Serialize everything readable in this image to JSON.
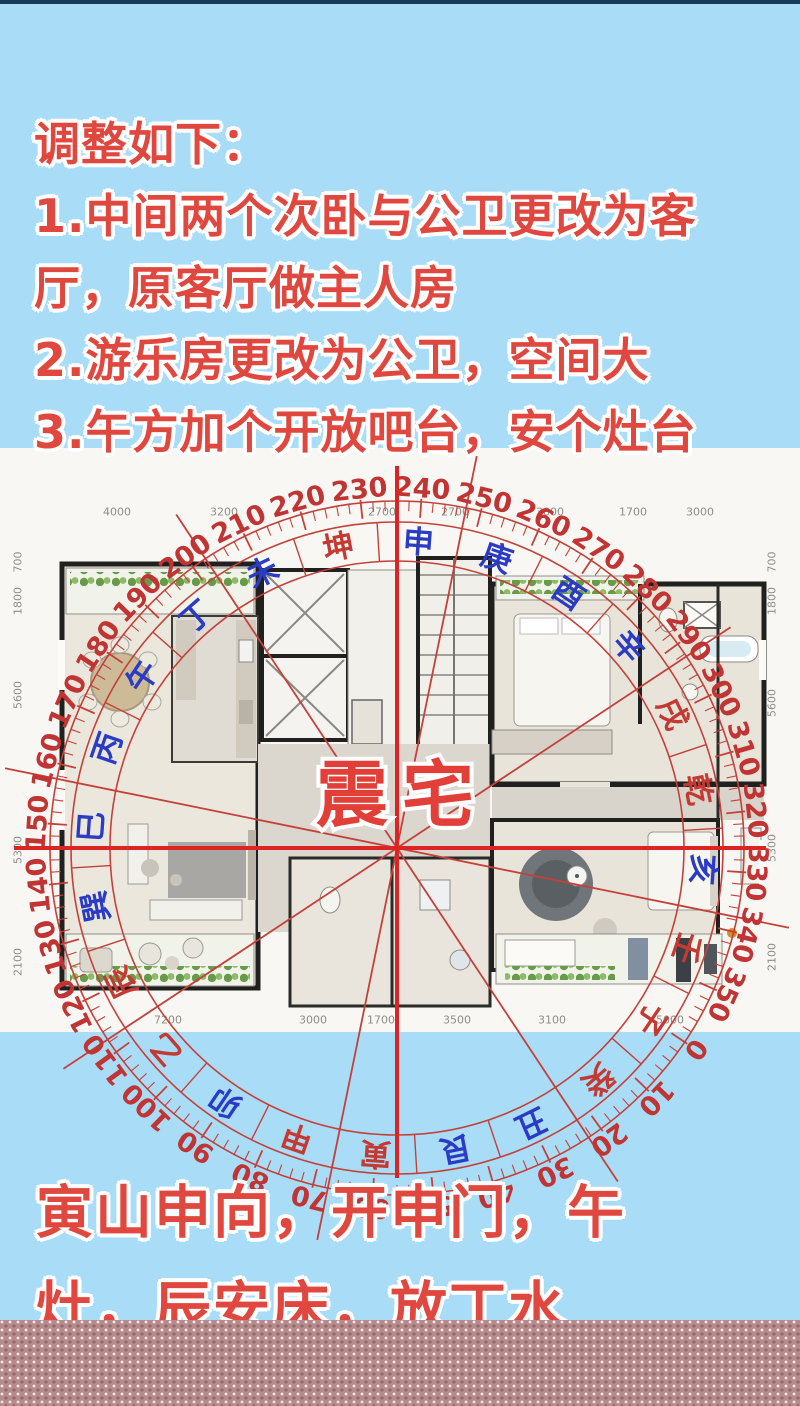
{
  "page": {
    "background_color": "#a9dcf7",
    "top_bar_color": "#16395e",
    "band_color": "#b78a8b"
  },
  "top_text": {
    "color": "#e0483f",
    "lines": [
      "调整如下：",
      "1.中间两个次卧与公卫更改为客",
      "厅，原客厅做主人房",
      "2.游乐房更改为公卫，空间大",
      "3.午方加个开放吧台，安个灶台"
    ]
  },
  "bottom_text": {
    "color": "#e0483f",
    "lines": [
      "寅山申向，开申门，午",
      "灶，辰安床，放丁水"
    ]
  },
  "compass": {
    "center_label": "震宅",
    "center_label_color": "#e23f38",
    "ring_color": "#c4413a",
    "crosshair_color": "#dd2424",
    "degree_label_color": "#c13434",
    "rotation_deg": 124,
    "degree_labels": [
      "0",
      "10",
      "20",
      "30",
      "40",
      "50",
      "60",
      "70",
      "80",
      "90",
      "100",
      "110",
      "120",
      "130",
      "140",
      "150",
      "160",
      "170",
      "180",
      "190",
      "200",
      "210",
      "220",
      "230",
      "240",
      "250",
      "260",
      "270",
      "280",
      "290",
      "300",
      "310",
      "320",
      "330",
      "340",
      "350"
    ],
    "mountain_colors": {
      "red": "#c43a33",
      "blue": "#2b3bc4"
    },
    "mountains": [
      {
        "name": "子",
        "deg": 0,
        "color": "red"
      },
      {
        "name": "癸",
        "deg": 15,
        "color": "red"
      },
      {
        "name": "丑",
        "deg": 30,
        "color": "blue"
      },
      {
        "name": "艮",
        "deg": 45,
        "color": "blue"
      },
      {
        "name": "寅",
        "deg": 60,
        "color": "red"
      },
      {
        "name": "甲",
        "deg": 75,
        "color": "red"
      },
      {
        "name": "卯",
        "deg": 90,
        "color": "blue"
      },
      {
        "name": "乙",
        "deg": 105,
        "color": "red"
      },
      {
        "name": "辰",
        "deg": 120,
        "color": "red"
      },
      {
        "name": "巽",
        "deg": 135,
        "color": "blue"
      },
      {
        "name": "巳",
        "deg": 150,
        "color": "blue"
      },
      {
        "name": "丙",
        "deg": 165,
        "color": "blue"
      },
      {
        "name": "午",
        "deg": 180,
        "color": "blue"
      },
      {
        "name": "丁",
        "deg": 195,
        "color": "blue"
      },
      {
        "name": "未",
        "deg": 210,
        "color": "blue"
      },
      {
        "name": "坤",
        "deg": 225,
        "color": "red"
      },
      {
        "name": "申",
        "deg": 240,
        "color": "blue"
      },
      {
        "name": "庚",
        "deg": 255,
        "color": "blue"
      },
      {
        "name": "酉",
        "deg": 270,
        "color": "blue"
      },
      {
        "name": "辛",
        "deg": 285,
        "color": "blue"
      },
      {
        "name": "戌",
        "deg": 300,
        "color": "red"
      },
      {
        "name": "乾",
        "deg": 315,
        "color": "red"
      },
      {
        "name": "亥",
        "deg": 330,
        "color": "blue"
      },
      {
        "name": "壬",
        "deg": 345,
        "color": "red"
      }
    ]
  },
  "floor_plan": {
    "dimension_color": "#8e8e88",
    "dimensions": {
      "top": [
        "4000",
        "3200",
        "2700",
        "2700",
        "3800",
        "1700",
        "3000"
      ],
      "bottom": [
        "7200",
        "3000",
        "1700",
        "3500",
        "3100",
        "5000"
      ],
      "left": [
        "700",
        "1800",
        "5600",
        "5300",
        "2100"
      ],
      "right": [
        "700",
        "1800",
        "5600",
        "5300",
        "2100"
      ]
    }
  }
}
